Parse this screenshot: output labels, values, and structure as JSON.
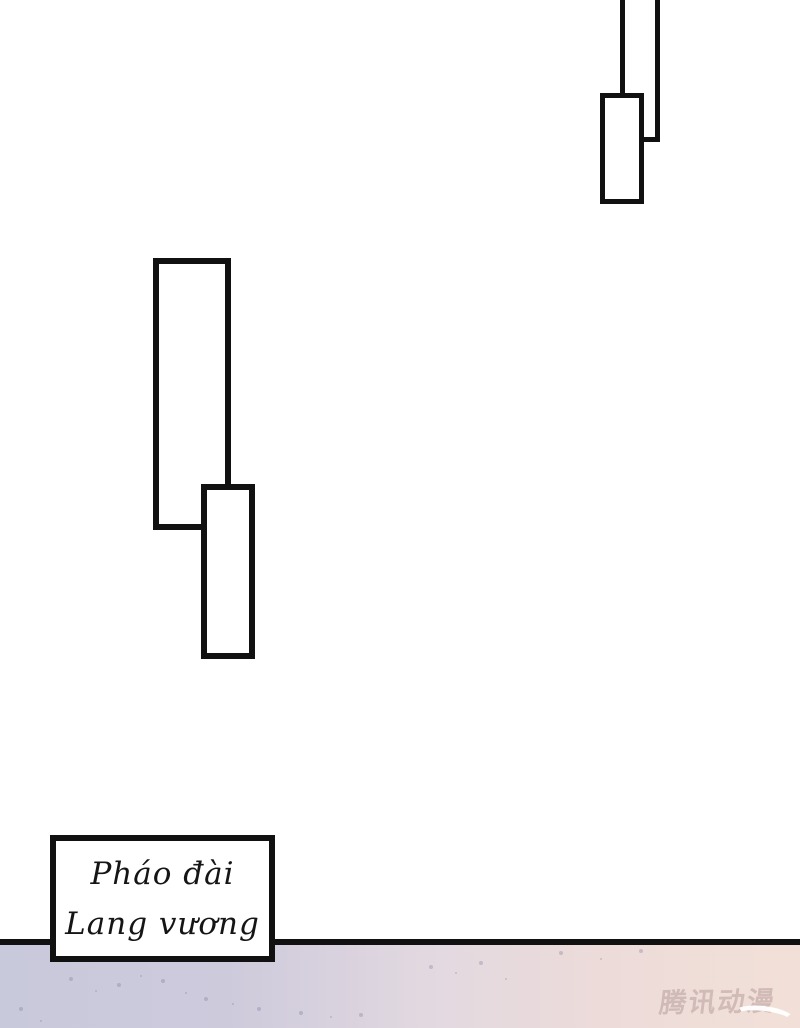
{
  "caption_box": {
    "line1": "Pháo đài",
    "line2": "Lang vương"
  },
  "watermark": {
    "text": "腾讯动漫"
  },
  "colors": {
    "ink": "#111111",
    "strip_left": "#c8c9db",
    "strip_mid": "#e3d9e0",
    "strip_right": "#f2e0d8",
    "watermark": "#a98c8c",
    "speckle": "#6a6a8c"
  }
}
